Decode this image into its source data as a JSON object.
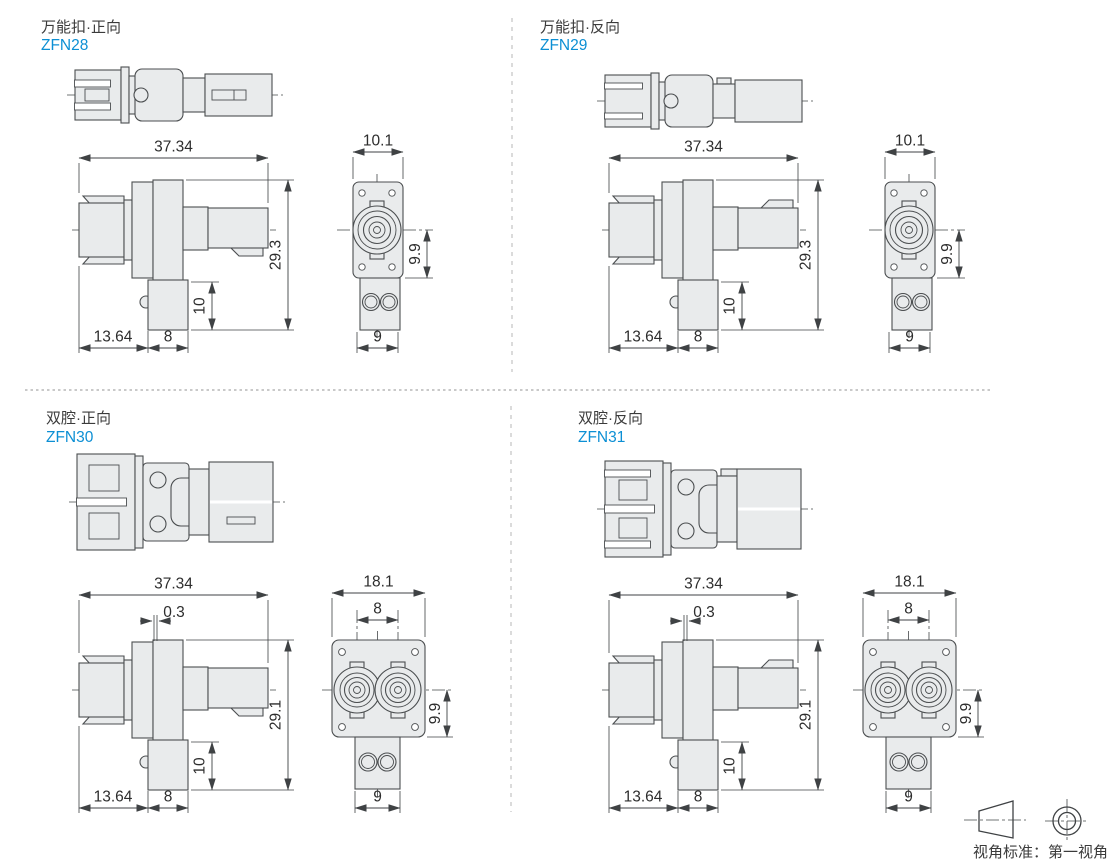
{
  "page": {
    "colors": {
      "accent_blue": "#0c8fd4",
      "line": "#4b4e50",
      "fill": "#e9ebec"
    },
    "footer": {
      "label": "视角标准：第一视角",
      "icons": [
        "first-angle-frustum-icon",
        "first-angle-front-icon"
      ]
    }
  },
  "products": [
    {
      "title": "万能扣·正向",
      "part_no": "ZFN28",
      "dims": {
        "total_width": "37.34",
        "total_height": "29.3",
        "leg_height": "10",
        "nose_length": "13.64",
        "leg_width": "8",
        "flange_width": "10.1",
        "center_to_bottom": "9.9",
        "boot_width": "9"
      }
    },
    {
      "title": "万能扣·反向",
      "part_no": "ZFN29",
      "dims": {
        "total_width": "37.34",
        "total_height": "29.3",
        "leg_height": "10",
        "nose_length": "13.64",
        "leg_width": "8",
        "flange_width": "10.1",
        "center_to_bottom": "9.9",
        "boot_width": "9"
      }
    },
    {
      "title": "双腔·正向",
      "part_no": "ZFN30",
      "dims": {
        "total_width": "37.34",
        "flange_offset": "0.3",
        "total_height": "29.1",
        "leg_height": "10",
        "nose_length": "13.64",
        "leg_width": "8",
        "flange_width": "18.1",
        "pitch": "8",
        "center_to_bottom": "9.9",
        "boot_width": "9"
      }
    },
    {
      "title": "双腔·反向",
      "part_no": "ZFN31",
      "dims": {
        "total_width": "37.34",
        "flange_offset": "0.3",
        "total_height": "29.1",
        "leg_height": "10",
        "nose_length": "13.64",
        "leg_width": "8",
        "flange_width": "18.1",
        "pitch": "8",
        "center_to_bottom": "9.9",
        "boot_width": "9"
      }
    }
  ]
}
